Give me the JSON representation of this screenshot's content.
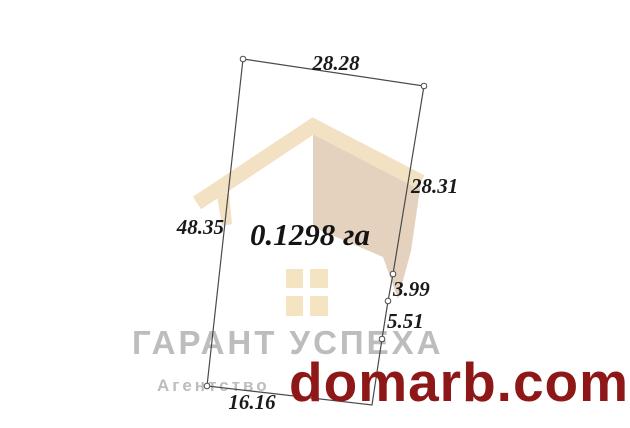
{
  "plot": {
    "area_label": "0.1298 га",
    "dimensions": {
      "top": "28.28",
      "right_upper": "28.31",
      "right_mid": "3.99",
      "right_lower": "5.51",
      "left": "48.35",
      "bottom": "16.16"
    },
    "outline_color": "#4a4a4a"
  },
  "watermark": {
    "agency_name": "ГАРАНТ УСПЕХА",
    "agency_type": "Агентство",
    "text_color": "#bdbdbd",
    "house_colors": {
      "roof": "#f2e1c3",
      "wall": "#e4d2be",
      "window": "#f4e4c1"
    }
  },
  "site": {
    "domain": "domarb.com",
    "color": "#8e1818"
  }
}
